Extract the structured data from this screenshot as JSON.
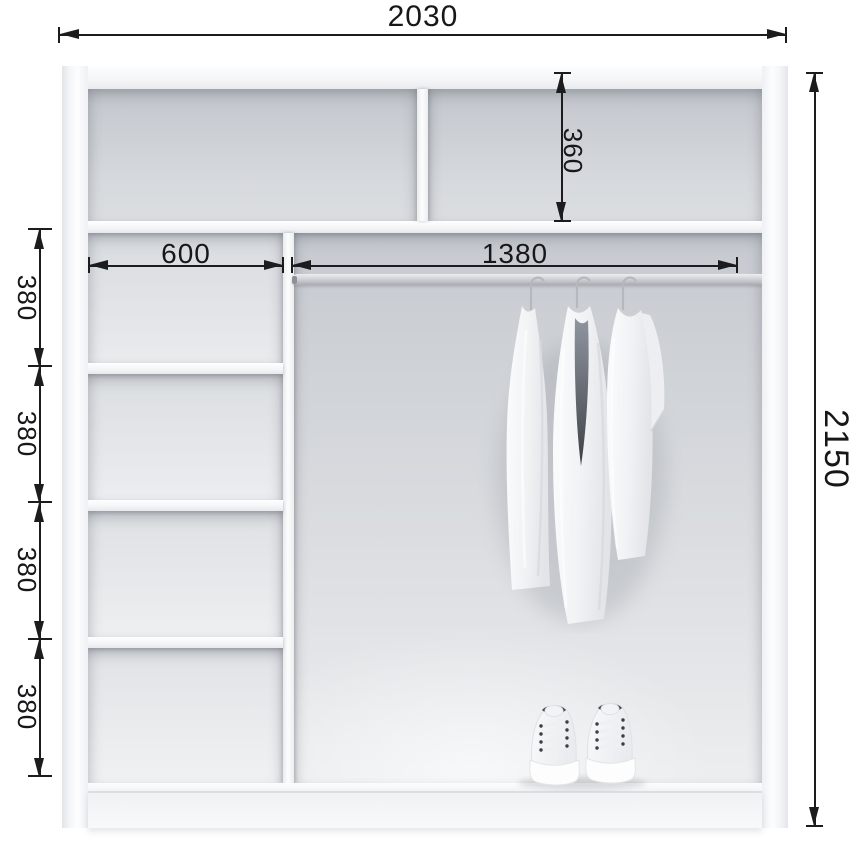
{
  "diagram": {
    "type": "wardrobe-interior-dimension-drawing",
    "dimensions": {
      "overall_width": "2030",
      "overall_height": "2150",
      "top_compartment_depth": "360",
      "shelf_section_width": "600",
      "rod_length": "1380",
      "shelf_gaps": [
        "380",
        "380",
        "380",
        "380"
      ]
    },
    "colors": {
      "dimension_ink": "#1c1c1e",
      "carcass_white": "#f7f8fa",
      "interior_gray": "#d2d5d9",
      "rod_gray": "#c5c8cc"
    },
    "contents": {
      "garments_on_rod": 3,
      "shoe_pairs": 1
    }
  }
}
